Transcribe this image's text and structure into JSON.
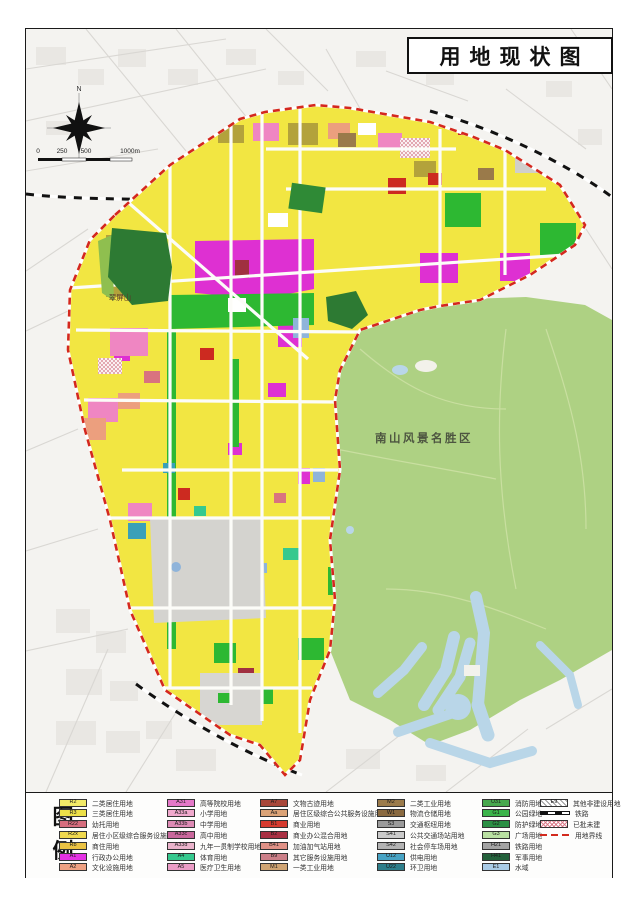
{
  "title": "用地现状图",
  "compass": {
    "north_label": "N"
  },
  "scale_bar": {
    "labels": [
      "0",
      "250",
      "500",
      "1000m"
    ]
  },
  "map": {
    "scenic_label": "南山风景名胜区",
    "hill_label": "翠屏山",
    "colors": {
      "boundary": "#d4281e",
      "area_fill": "#f2e642",
      "scenic_fill": "#aed183",
      "water": "#b9d6e8",
      "hill_green": "#2d7a33"
    }
  },
  "legend": {
    "heading_chars": [
      "图",
      "例"
    ],
    "columns": [
      {
        "rows": [
          {
            "code": "R2",
            "label": "二类居住用地",
            "color": "#f2ea68"
          },
          {
            "code": "R3",
            "label": "三类居住用地",
            "color": "#ece049"
          },
          {
            "code": "R22",
            "label": "幼托用地",
            "color": "#d66e7e"
          },
          {
            "code": "R2x",
            "label": "居住小区级综合服务设施用地",
            "color": "#f0d94e"
          },
          {
            "code": "Rb",
            "label": "商住用地",
            "color": "#eac243"
          },
          {
            "code": "A1",
            "label": "行政办公用地",
            "color": "#e431e4"
          },
          {
            "code": "A2",
            "label": "文化设施用地",
            "color": "#efa183"
          }
        ]
      },
      {
        "rows": [
          {
            "code": "A31",
            "label": "高等院校用地",
            "color": "#e478c8"
          },
          {
            "code": "A33a",
            "label": "小学用地",
            "color": "#f0a9cd"
          },
          {
            "code": "A33b",
            "label": "中学用地",
            "color": "#de8bb5"
          },
          {
            "code": "A33c",
            "label": "高中用地",
            "color": "#c9679c"
          },
          {
            "code": "A33d",
            "label": "九年一贯制学校用地",
            "color": "#eab3cb"
          },
          {
            "code": "A4",
            "label": "体育用地",
            "color": "#35c98e"
          },
          {
            "code": "A5",
            "label": "医疗卫生用地",
            "color": "#eb9cc6"
          }
        ]
      },
      {
        "rows": [
          {
            "code": "A7",
            "label": "文物古迹用地",
            "color": "#a8473a"
          },
          {
            "code": "Aa",
            "label": "居住区级综合公共服务设施用地",
            "color": "#dba377"
          },
          {
            "code": "B1",
            "label": "商业用地",
            "color": "#d63b2f"
          },
          {
            "code": "B2",
            "label": "商业办公混合用地",
            "color": "#a93043"
          },
          {
            "code": "B41",
            "label": "加油加气站用地",
            "color": "#e09186"
          },
          {
            "code": "B9",
            "label": "其它服务设施用地",
            "color": "#cb7f88"
          },
          {
            "code": "M1",
            "label": "一类工业用地",
            "color": "#cfa473"
          }
        ]
      },
      {
        "rows": [
          {
            "code": "M2",
            "label": "二类工业用地",
            "color": "#9b7b4b"
          },
          {
            "code": "W1",
            "label": "物流仓储用地",
            "color": "#8a6a40"
          },
          {
            "code": "S3",
            "label": "交通枢纽用地",
            "color": "#9b9b9b"
          },
          {
            "code": "S41",
            "label": "公共交通场站用地",
            "color": "#cacaca"
          },
          {
            "code": "S42",
            "label": "社会停车场用地",
            "color": "#b3b3b3"
          },
          {
            "code": "U12",
            "label": "供电用地",
            "color": "#47a3c4"
          },
          {
            "code": "U22",
            "label": "环卫用地",
            "color": "#2e7e8a"
          }
        ]
      },
      {
        "rows": [
          {
            "code": "U31",
            "label": "消防用地",
            "color": "#48a84e"
          },
          {
            "code": "G1",
            "label": "公园绿地",
            "color": "#3cb44b"
          },
          {
            "code": "G2",
            "label": "防护绿地",
            "color": "#2b8f44"
          },
          {
            "code": "G3",
            "label": "广场用地",
            "color": "#b9e0a2"
          },
          {
            "code": "H21",
            "label": "铁路用地",
            "color": "#a3a3a3"
          },
          {
            "code": "H41",
            "label": "军事用地",
            "color": "#23603a"
          },
          {
            "code": "E1",
            "label": "水域",
            "color": "#a9cbe6"
          }
        ]
      },
      {
        "rows": [
          {
            "code": "E9",
            "label": "其他非建设用地",
            "type": "hatch-gray"
          },
          {
            "code": "",
            "label": "铁路",
            "type": "railway"
          },
          {
            "code": "",
            "label": "已批未建",
            "type": "hatch-pink"
          },
          {
            "code": "",
            "label": "用地界线",
            "type": "dash-red"
          }
        ]
      }
    ]
  }
}
